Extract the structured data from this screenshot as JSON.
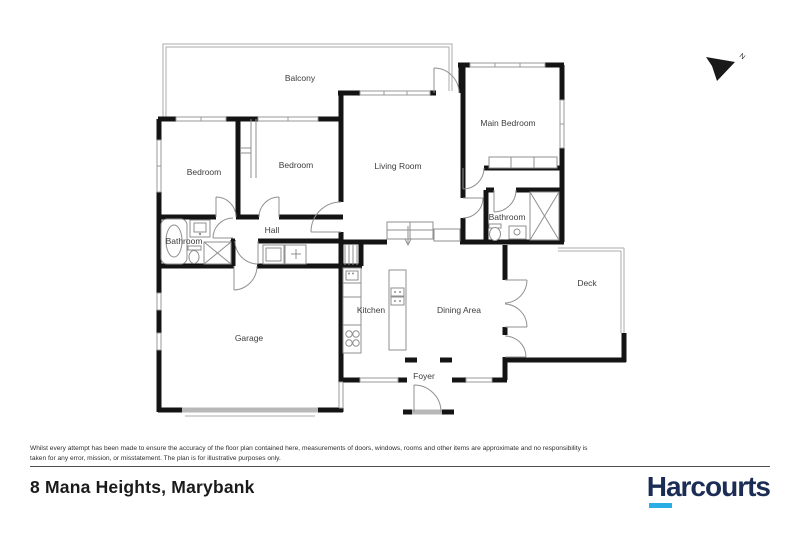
{
  "colors": {
    "wall": "#141414",
    "window": "#b8b8b8",
    "label_text": "#3d3d3d",
    "brand_navy": "#1c2d55",
    "brand_cyan": "#2aaee5"
  },
  "floor_plan": {
    "north_indicator": "N",
    "rooms": [
      {
        "name": "balcony",
        "label": "Balcony"
      },
      {
        "name": "bedroom-left",
        "label": "Bedroom"
      },
      {
        "name": "bedroom-middle",
        "label": "Bedroom"
      },
      {
        "name": "living-room",
        "label": "Living Room"
      },
      {
        "name": "main-bedroom",
        "label": "Main Bedroom"
      },
      {
        "name": "bathroom-left",
        "label": "Bathroom"
      },
      {
        "name": "hall",
        "label": "Hall"
      },
      {
        "name": "bathroom-right",
        "label": "Bathroom"
      },
      {
        "name": "kitchen",
        "label": "Kitchen"
      },
      {
        "name": "dining-area",
        "label": "Dining Area"
      },
      {
        "name": "deck",
        "label": "Deck"
      },
      {
        "name": "garage",
        "label": "Garage"
      },
      {
        "name": "foyer",
        "label": "Foyer"
      }
    ]
  },
  "footer": {
    "disclaimer": "Whilst every attempt has been made to ensure the accuracy of the floor plan contained here, measurements of doors, windows, rooms and other items are approximate and no responsibility is taken for any error, mission, or misstatement. The plan is for illustrative purposes only.",
    "address": "8 Mana Heights, Marybank",
    "brand_name": "Harcourts"
  }
}
